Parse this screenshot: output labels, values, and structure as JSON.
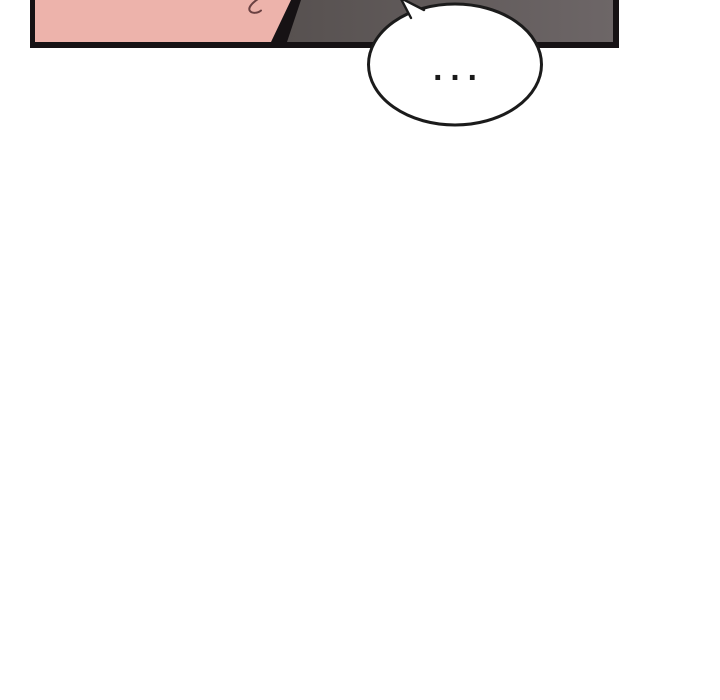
{
  "page": {
    "background": "#ffffff"
  },
  "panel": {
    "border_color": "#161214",
    "skin_color": "#edb3ab",
    "shadow_color_left": "#575150",
    "shadow_color_right": "#6d6667",
    "hair_strand_color": "#6a4142"
  },
  "speech_bubble": {
    "text": "...",
    "fill_color": "#ffffff",
    "stroke_color": "#1b1b1b",
    "text_color": "#1a1a1a"
  }
}
